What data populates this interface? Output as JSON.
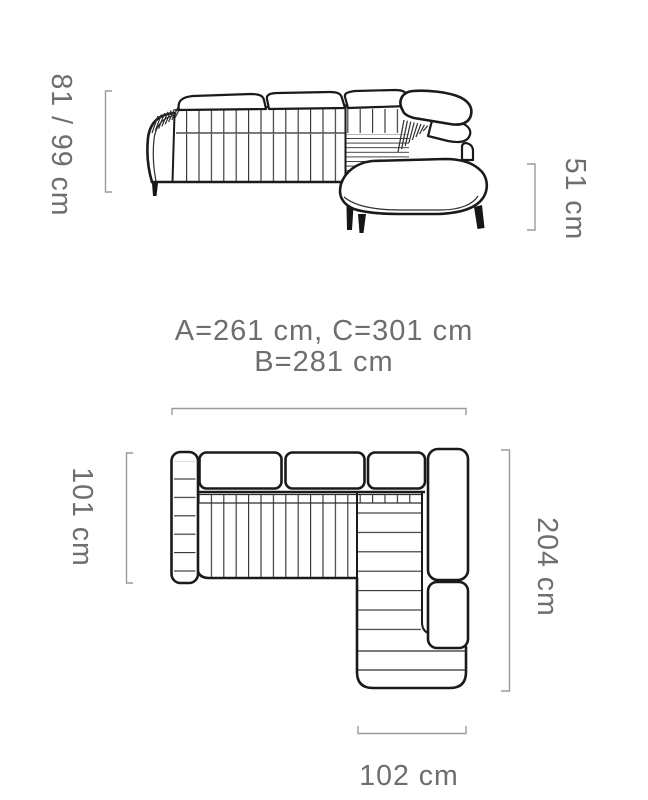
{
  "front_view": {
    "height_label": "81 / 99 cm",
    "seat_height_label": "51 cm"
  },
  "overall_dimensions": {
    "line1": "A=261 cm, C=301 cm",
    "line2": "B=281 cm"
  },
  "top_view": {
    "depth_label": "101 cm",
    "length_label": "204 cm",
    "chaise_width_label": "102 cm"
  },
  "colors": {
    "outline": "#1a1a1a",
    "dimension_lines": "#9b9b9b",
    "dimension_text": "#6e6e6e",
    "background": "#ffffff"
  }
}
